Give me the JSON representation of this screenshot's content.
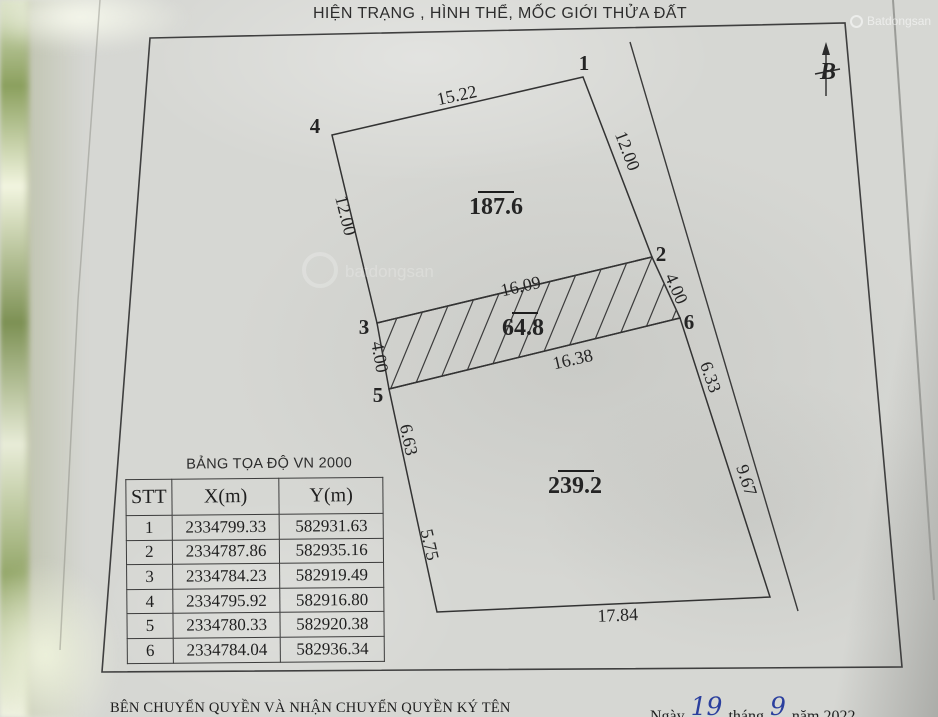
{
  "title": "HIỆN TRẠNG , HÌNH THỂ, MỐC GIỚI THỬA ĐẤT",
  "compass": {
    "north_label": "B"
  },
  "diagram": {
    "vertices": {
      "v1": "1",
      "v2": "2",
      "v3": "3",
      "v4": "4",
      "v5": "5",
      "v6": "6"
    },
    "areas": {
      "parcel_top": "187.6",
      "parcel_middle": "64.8",
      "parcel_bottom": "239.2"
    },
    "dimensions": {
      "top_width": "15.22",
      "left_top": "12.00",
      "right_top": "12.00",
      "mid_top_width": "16.09",
      "mid_left": "4.00",
      "mid_right": "4.00",
      "mid_bottom_width": "16.38",
      "left_mid": "6.63",
      "left_bottom": "5.75",
      "right_mid": "6.33",
      "right_bottom": "9.67",
      "bottom_width": "17.84"
    }
  },
  "table": {
    "title": "BẢNG TỌA ĐỘ VN 2000",
    "headers": [
      "STT",
      "X(m)",
      "Y(m)"
    ],
    "rows": [
      {
        "stt": "1",
        "x": "2334799.33",
        "y": "582931.63"
      },
      {
        "stt": "2",
        "x": "2334787.86",
        "y": "582935.16"
      },
      {
        "stt": "3",
        "x": "2334784.23",
        "y": "582919.49"
      },
      {
        "stt": "4",
        "x": "2334795.92",
        "y": "582916.80"
      },
      {
        "stt": "5",
        "x": "2334780.33",
        "y": "582920.38"
      },
      {
        "stt": "6",
        "x": "2334784.04",
        "y": "582936.34"
      }
    ]
  },
  "footer": {
    "sign_text": "BÊN CHUYỂN QUYỀN VÀ NHẬN CHUYỂN QUYỀN KÝ TÊN",
    "date_word": "Ngày",
    "day": "19",
    "month_word": "tháng",
    "month": "9",
    "year_word": "năm 2022"
  },
  "watermark": {
    "brand": "Batdongsan"
  }
}
